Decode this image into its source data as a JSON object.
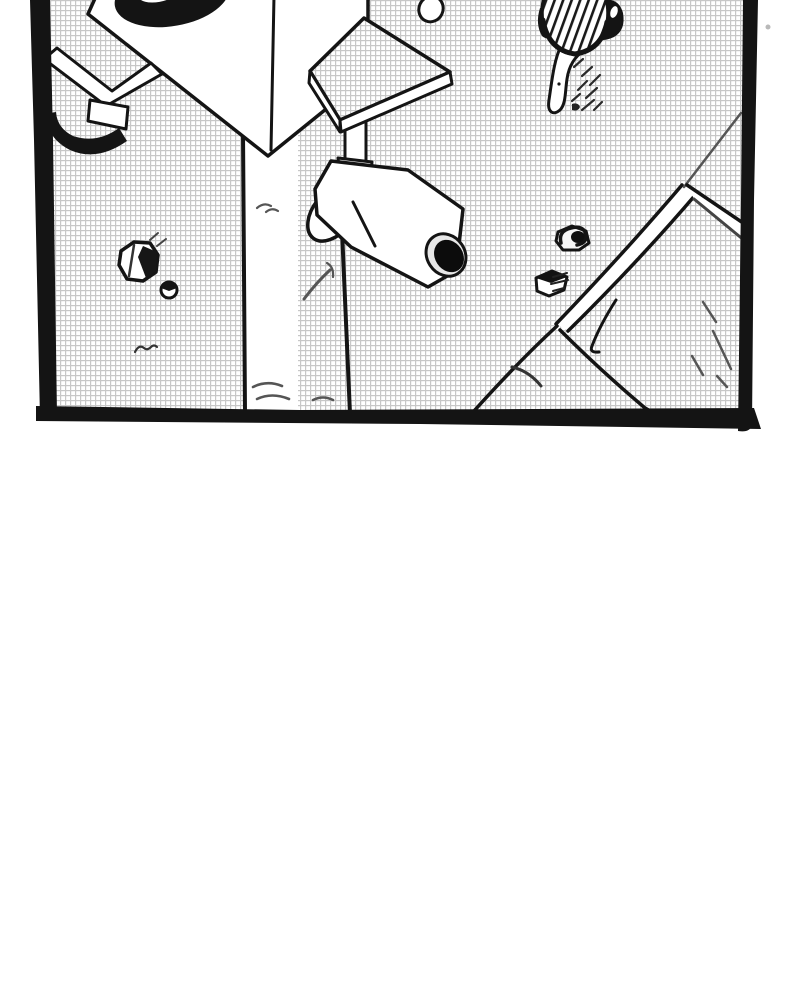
{
  "meta": {
    "kind": "comic-panel",
    "medium": "black-and-white manga illustration, bird's-eye view"
  },
  "panel": {
    "description": "Overhead view of a utility pole topped by a loudspeaker box with a signboard and CCTV security camera, standing over a screentoned street; a pedestrian in a striped hat walks at top right; a diagonal curb and walkway occupy the lower right; scattered rocks and grass tufts on the ground; lower half of page is blank paper",
    "bounds": {
      "left": 30,
      "top": 0,
      "right": 762,
      "bottom": 432
    },
    "background": "fine gray crosshatch screentone grid"
  },
  "colors": {
    "ink": "#141414",
    "paper": "#ffffff",
    "tone_line": "#c7c7c7",
    "soft_ink": "#555555",
    "speck": "#b9b9b9",
    "lens_hole": "#0c0c0c",
    "lens_rim": "#e8e8e8"
  },
  "elements": [
    {
      "name": "panel-border",
      "kind": "frame"
    },
    {
      "name": "ground-screentone",
      "kind": "background"
    },
    {
      "name": "loudspeaker-box",
      "kind": "structure"
    },
    {
      "name": "speaker-opening",
      "kind": "detail"
    },
    {
      "name": "horn-flare",
      "kind": "detail"
    },
    {
      "name": "horn-shadow",
      "kind": "detail"
    },
    {
      "name": "signboard",
      "kind": "structure"
    },
    {
      "name": "sign-post",
      "kind": "structure"
    },
    {
      "name": "cctv-camera",
      "kind": "structure"
    },
    {
      "name": "camera-lens",
      "kind": "detail"
    },
    {
      "name": "utility-pole",
      "kind": "structure"
    },
    {
      "name": "pedestrian",
      "kind": "figure"
    },
    {
      "name": "striped-hat",
      "kind": "figure-detail"
    },
    {
      "name": "hair",
      "kind": "figure-detail"
    },
    {
      "name": "ring-mark",
      "kind": "prop"
    },
    {
      "name": "rock-large",
      "kind": "prop"
    },
    {
      "name": "pebble",
      "kind": "prop"
    },
    {
      "name": "stone-dark",
      "kind": "prop"
    },
    {
      "name": "stone-white",
      "kind": "prop"
    },
    {
      "name": "curb-edge",
      "kind": "ground-line"
    },
    {
      "name": "walkway-platform",
      "kind": "ground"
    },
    {
      "name": "grass-marks",
      "kind": "detail"
    },
    {
      "name": "dust-speck",
      "kind": "detail"
    }
  ]
}
